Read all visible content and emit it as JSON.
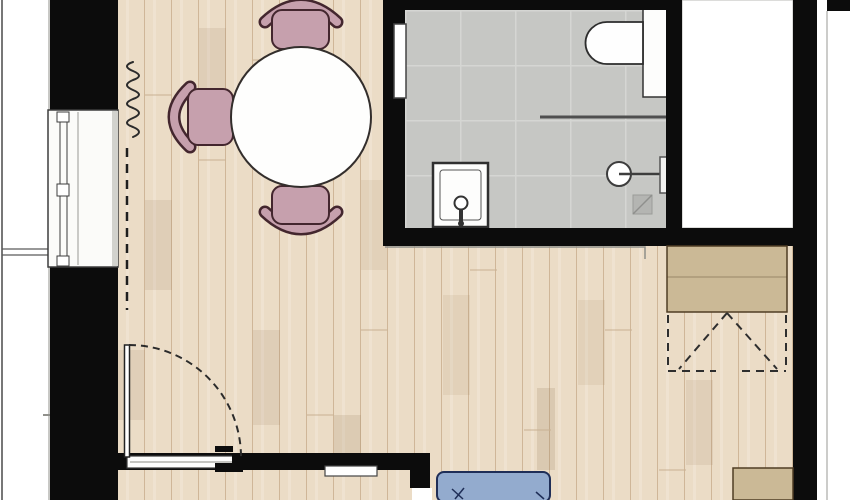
{
  "canvas": {
    "width": 850,
    "height": 500
  },
  "colors": {
    "wall": "#0c0c0c",
    "wood_floor": "#ebdcc6",
    "wood_plank_line": "#cfb698",
    "tile_floor": "#c6c7c4",
    "tile_grid_line": "#d5d6d3",
    "chair_pink": "#c6a0ad",
    "chair_outline": "#43262e",
    "table_white": "#fefefd",
    "wardrobe_tan": "#cbb996",
    "wardrobe_outline": "#4f3d24",
    "sofa_blue": "#93abce",
    "sofa_outline": "#1f2e57",
    "fixture_white": "#fdfdfc",
    "fixture_outline": "#2d2d2d",
    "exterior_white": "#ffffff"
  },
  "elements": [
    {
      "name": "exterior-ground",
      "type": "rect",
      "x": 0,
      "y": 0,
      "w": 850,
      "h": 500,
      "fill": "#ffffff"
    },
    {
      "name": "wood-floor",
      "type": "rect",
      "x": 118,
      "y": 0,
      "w": 675,
      "h": 500,
      "fill": "url(#wood)"
    },
    {
      "name": "plank-shade",
      "type": "rect",
      "x": 145,
      "y": 200,
      "w": 27,
      "h": 90,
      "fill": "rgba(146,117,82,0.13)"
    },
    {
      "name": "plank-shade",
      "type": "rect",
      "x": 199,
      "y": 28,
      "w": 27,
      "h": 75,
      "fill": "rgba(146,117,82,0.13)"
    },
    {
      "name": "plank-shade",
      "type": "rect",
      "x": 253,
      "y": 330,
      "w": 27,
      "h": 95,
      "fill": "rgba(146,117,82,0.13)"
    },
    {
      "name": "plank-shade",
      "type": "rect",
      "x": 334,
      "y": 415,
      "w": 27,
      "h": 55,
      "fill": "rgba(146,117,82,0.16)"
    },
    {
      "name": "plank-shade",
      "type": "rect",
      "x": 361,
      "y": 180,
      "w": 26,
      "h": 90,
      "fill": "rgba(146,117,82,0.10)"
    },
    {
      "name": "plank-shade",
      "type": "rect",
      "x": 443,
      "y": 295,
      "w": 27,
      "h": 100,
      "fill": "rgba(146,117,82,0.10)"
    },
    {
      "name": "plank-shade",
      "type": "rect",
      "x": 537,
      "y": 388,
      "w": 18,
      "h": 82,
      "fill": "rgba(146,117,82,0.18)"
    },
    {
      "name": "plank-shade",
      "type": "rect",
      "x": 578,
      "y": 300,
      "w": 27,
      "h": 85,
      "fill": "rgba(146,117,82,0.10)"
    },
    {
      "name": "plank-shade",
      "type": "rect",
      "x": 686,
      "y": 380,
      "w": 27,
      "h": 85,
      "fill": "rgba(146,117,82,0.12)"
    },
    {
      "name": "plank-shade",
      "type": "rect",
      "x": 118,
      "y": 350,
      "w": 27,
      "h": 70,
      "fill": "rgba(146,117,82,0.12)"
    },
    {
      "name": "plank-joint",
      "type": "path",
      "d": "M145 95 H172",
      "stroke": "#c8b193",
      "sw": 1
    },
    {
      "name": "plank-joint",
      "type": "path",
      "d": "M199 160 H226",
      "stroke": "#c8b193",
      "sw": 1
    },
    {
      "name": "plank-joint",
      "type": "path",
      "d": "M253 60 H280",
      "stroke": "#c8b193",
      "sw": 1
    },
    {
      "name": "plank-joint",
      "type": "path",
      "d": "M307 415 H334",
      "stroke": "#c8b193",
      "sw": 1
    },
    {
      "name": "plank-joint",
      "type": "path",
      "d": "M361 330 H388",
      "stroke": "#c8b193",
      "sw": 1
    },
    {
      "name": "plank-joint",
      "type": "path",
      "d": "M470 270 H497",
      "stroke": "#c8b193",
      "sw": 1
    },
    {
      "name": "plank-joint",
      "type": "path",
      "d": "M524 430 H551",
      "stroke": "#c8b193",
      "sw": 1
    },
    {
      "name": "plank-joint",
      "type": "path",
      "d": "M605 330 H632",
      "stroke": "#c8b193",
      "sw": 1
    },
    {
      "name": "plank-joint",
      "type": "path",
      "d": "M659 470 H686",
      "stroke": "#c8b193",
      "sw": 1
    },
    {
      "name": "plank-joint",
      "type": "path",
      "d": "M713 300 H740",
      "stroke": "#c8b193",
      "sw": 1
    },
    {
      "name": "balcony-edge-line",
      "type": "path",
      "d": "M2 0 V500",
      "stroke": "#4a4a4a",
      "sw": 1.5
    },
    {
      "name": "facade-line-left",
      "type": "path",
      "d": "M49 0 V500",
      "stroke": "#90908b",
      "sw": 1
    },
    {
      "name": "balcony-divider-line",
      "type": "path",
      "d": "M2 249 H50",
      "stroke": "#5a5a5a",
      "sw": 1.2
    },
    {
      "name": "balcony-divider-line",
      "type": "path",
      "d": "M2 255 H50",
      "stroke": "#5a5a5a",
      "sw": 1.2
    },
    {
      "name": "facade-mark",
      "type": "path",
      "d": "M43 415 H51",
      "stroke": "#90908b",
      "sw": 2
    },
    {
      "name": "radiator-symbol",
      "type": "path",
      "d": "M133 62 Q121 66 133 71 Q145 76 133 80 Q121 85 133 90 Q145 95 133 99 Q121 104 133 108 Q145 113 133 118 Q121 123 133 127 Q145 132 133 137",
      "stroke": "#2b2b2b",
      "sw": 2,
      "cap": "round"
    },
    {
      "name": "projection-dashed-line",
      "type": "path",
      "d": "M127 148 V310",
      "stroke": "#1e1e1e",
      "sw": 2.5,
      "dash": "9 7"
    },
    {
      "name": "chair-top-back-outline",
      "type": "path",
      "d": "M265 22 Q301 -12 337 22",
      "stroke": "#43262e",
      "sw": 13,
      "cap": "round"
    },
    {
      "name": "chair-top-back",
      "type": "path",
      "d": "M265 22 Q301 -12 337 22",
      "stroke": "#c6a0ad",
      "sw": 8,
      "cap": "round"
    },
    {
      "name": "chair-top-seat",
      "type": "rect",
      "x": 272,
      "y": 10,
      "w": 57,
      "h": 39,
      "rx": 10,
      "fill": "#c6a0ad",
      "stroke": "#43262e",
      "sw": 2
    },
    {
      "name": "chair-left-back-outline",
      "type": "path",
      "d": "M190 87 Q158 117 190 147",
      "stroke": "#43262e",
      "sw": 13,
      "cap": "round"
    },
    {
      "name": "chair-left-back",
      "type": "path",
      "d": "M190 87 Q158 117 190 147",
      "stroke": "#c6a0ad",
      "sw": 8,
      "cap": "round"
    },
    {
      "name": "chair-left-seat",
      "type": "rect",
      "x": 188,
      "y": 89,
      "w": 45,
      "h": 56,
      "rx": 10,
      "fill": "#c6a0ad",
      "stroke": "#43262e",
      "sw": 2
    },
    {
      "name": "chair-bottom-back-outline",
      "type": "path",
      "d": "M265 212 Q301 246 337 212",
      "stroke": "#43262e",
      "sw": 13,
      "cap": "round"
    },
    {
      "name": "chair-bottom-back",
      "type": "path",
      "d": "M265 212 Q301 246 337 212",
      "stroke": "#c6a0ad",
      "sw": 8,
      "cap": "round"
    },
    {
      "name": "chair-bottom-seat",
      "type": "rect",
      "x": 272,
      "y": 186,
      "w": 57,
      "h": 38,
      "rx": 10,
      "fill": "#c6a0ad",
      "stroke": "#43262e",
      "sw": 2
    },
    {
      "name": "dining-table",
      "type": "circle",
      "cx": 301,
      "cy": 117,
      "r": 70,
      "fill": "#fefefd",
      "stroke": "#332e2c",
      "sw": 2
    },
    {
      "name": "bathroom-floor",
      "type": "rect",
      "x": 405,
      "y": 10,
      "w": 261,
      "h": 218,
      "fill": "url(#tile)"
    },
    {
      "name": "shower-partition-line",
      "type": "path",
      "d": "M540 117 H666",
      "stroke": "#4f4f4f",
      "sw": 3
    },
    {
      "name": "toilet-cistern-panel",
      "type": "rect",
      "x": 643,
      "y": 8,
      "w": 24,
      "h": 89,
      "fill": "#fdfdfc",
      "stroke": "#333333",
      "sw": 1.5
    },
    {
      "name": "toilet-bowl",
      "type": "path",
      "d": "M643 22 H607 A21.5 21 0 0 0 607 64 H643 Z",
      "fill": "#fefefe",
      "stroke": "#2d2d2d",
      "sw": 1.8
    },
    {
      "name": "shower-tray",
      "type": "rect",
      "x": 433,
      "y": 163,
      "w": 55,
      "h": 64,
      "fill": "#fdfdfc",
      "stroke": "#2f2f2f",
      "sw": 2.5
    },
    {
      "name": "shower-tray-inner",
      "type": "rect",
      "x": 440,
      "y": 170,
      "w": 41,
      "h": 50,
      "rx": 3,
      "fill": "none",
      "stroke": "#555555",
      "sw": 1
    },
    {
      "name": "shower-valve",
      "type": "circle",
      "cx": 461,
      "cy": 203,
      "r": 6.5,
      "fill": "#ffffff",
      "stroke": "#333333",
      "sw": 2
    },
    {
      "name": "shower-valve-stem",
      "type": "path",
      "d": "M461 209 V222",
      "stroke": "#333333",
      "sw": 4
    },
    {
      "name": "shower-valve-base",
      "type": "circle",
      "cx": 461,
      "cy": 223.5,
      "r": 3,
      "fill": "#333333"
    },
    {
      "name": "washbasin",
      "type": "circle",
      "cx": 619,
      "cy": 174,
      "r": 12,
      "fill": "#ffffff",
      "stroke": "#3d3d3d",
      "sw": 2
    },
    {
      "name": "washbasin-faucet-line",
      "type": "path",
      "d": "M619 174 H663",
      "stroke": "#3d3d3d",
      "sw": 2.5
    },
    {
      "name": "washbasin-bracket",
      "type": "rect",
      "x": 660,
      "y": 157,
      "w": 10,
      "h": 36,
      "fill": "#f2f2f0",
      "stroke": "#555555",
      "sw": 1.5
    },
    {
      "name": "floor-drain",
      "type": "rect",
      "x": 633,
      "y": 195,
      "w": 19,
      "h": 19,
      "fill": "#b4b5b2",
      "stroke": "#9b9c99",
      "sw": 1
    },
    {
      "name": "floor-drain-diagonal",
      "type": "path",
      "d": "M633 214 L652 195",
      "stroke": "#8f908d",
      "sw": 1.5
    },
    {
      "name": "shaft-room",
      "type": "rect",
      "x": 682,
      "y": 0,
      "w": 111,
      "h": 228,
      "fill": "#ffffff",
      "stroke": "#b8b8b4",
      "sw": 1
    },
    {
      "name": "wall-bathroom-top",
      "type": "rect",
      "x": 383,
      "y": 0,
      "w": 299,
      "h": 10,
      "fill": "#0c0c0c"
    },
    {
      "name": "wall-bathroom-left",
      "type": "rect",
      "x": 383,
      "y": 10,
      "w": 22,
      "h": 218,
      "fill": "#0c0c0c"
    },
    {
      "name": "wall-bathroom-right",
      "type": "rect",
      "x": 666,
      "y": 10,
      "w": 16,
      "h": 218,
      "fill": "#0c0c0c"
    },
    {
      "name": "wall-bathroom-bottom",
      "type": "rect",
      "x": 383,
      "y": 228,
      "w": 410,
      "h": 18,
      "fill": "#0c0c0c"
    },
    {
      "name": "wall-right",
      "type": "rect",
      "x": 793,
      "y": 0,
      "w": 24,
      "h": 500,
      "fill": "#0c0c0c"
    },
    {
      "name": "wall-left-top",
      "type": "rect",
      "x": 50,
      "y": 0,
      "w": 68,
      "h": 110,
      "fill": "#0c0c0c"
    },
    {
      "name": "wall-left-bottom",
      "type": "rect",
      "x": 50,
      "y": 267,
      "w": 68,
      "h": 233,
      "fill": "#0c0c0c"
    },
    {
      "name": "wall-bottom",
      "type": "rect",
      "x": 118,
      "y": 453,
      "w": 312,
      "h": 17,
      "fill": "#0c0c0c"
    },
    {
      "name": "wall-bottom-stub",
      "type": "rect",
      "x": 410,
      "y": 453,
      "w": 20,
      "h": 35,
      "fill": "#0c0c0c"
    },
    {
      "name": "bathroom-door-panel",
      "type": "rect",
      "x": 394,
      "y": 24,
      "w": 12,
      "h": 74,
      "fill": "#ffffff",
      "stroke": "#444444",
      "sw": 1.5
    },
    {
      "name": "floor-step-line",
      "type": "path",
      "d": "M385 247 H645 V259",
      "stroke": "#8e8e89",
      "sw": 1.5
    },
    {
      "name": "window-frame",
      "type": "rect",
      "x": 48,
      "y": 110,
      "w": 70,
      "h": 157,
      "fill": "#fbfbf9",
      "stroke": "#3d3d3d",
      "sw": 1.5
    },
    {
      "name": "window-glazing-line",
      "type": "path",
      "d": "M60 112 V265",
      "stroke": "#3d3d3d",
      "sw": 1
    },
    {
      "name": "window-glazing-line",
      "type": "path",
      "d": "M67 112 V265",
      "stroke": "#3d3d3d",
      "sw": 1
    },
    {
      "name": "window-glazing-line",
      "type": "path",
      "d": "M78 112 V265",
      "stroke": "#9a9a95",
      "sw": 1
    },
    {
      "name": "window-mullion-block",
      "type": "rect",
      "x": 57,
      "y": 112,
      "w": 12,
      "h": 10,
      "fill": "#ffffff",
      "stroke": "#3d3d3d",
      "sw": 1
    },
    {
      "name": "window-mullion-block",
      "type": "rect",
      "x": 57,
      "y": 184,
      "w": 12,
      "h": 12,
      "fill": "#ffffff",
      "stroke": "#3d3d3d",
      "sw": 1
    },
    {
      "name": "window-mullion-block",
      "type": "rect",
      "x": 57,
      "y": 256,
      "w": 12,
      "h": 10,
      "fill": "#ffffff",
      "stroke": "#3d3d3d",
      "sw": 1
    },
    {
      "name": "window-sill-shade",
      "type": "rect",
      "x": 112,
      "y": 111,
      "w": 6,
      "h": 155,
      "fill": "#d2d2cd"
    },
    {
      "name": "wardrobe",
      "type": "rect",
      "x": 667,
      "y": 246,
      "w": 120,
      "h": 66,
      "fill": "#cbb996",
      "stroke": "#4f3d24",
      "sw": 1.5
    },
    {
      "name": "wardrobe-divider-line",
      "type": "path",
      "d": "M667 277 H787",
      "stroke": "rgba(79,61,36,0.4)",
      "sw": 1
    },
    {
      "name": "wardrobe-clearance-dashed",
      "type": "path",
      "d": "M668 315 V371",
      "stroke": "#2e2e2e",
      "sw": 2,
      "dash": "8 6"
    },
    {
      "name": "wardrobe-clearance-dashed",
      "type": "path",
      "d": "M786 315 V371",
      "stroke": "#2e2e2e",
      "sw": 2,
      "dash": "8 6"
    },
    {
      "name": "wardrobe-clearance-dashed",
      "type": "path",
      "d": "M668 371 H716",
      "stroke": "#2e2e2e",
      "sw": 2,
      "dash": "8 6"
    },
    {
      "name": "wardrobe-clearance-dashed",
      "type": "path",
      "d": "M742 371 H786",
      "stroke": "#2e2e2e",
      "sw": 2,
      "dash": "8 6"
    },
    {
      "name": "wardrobe-door-swing-dashed",
      "type": "path",
      "d": "M727 313 L679 369",
      "stroke": "#2e2e2e",
      "sw": 2,
      "dash": "8 6"
    },
    {
      "name": "wardrobe-door-swing-dashed",
      "type": "path",
      "d": "M727 313 L777 369",
      "stroke": "#2e2e2e",
      "sw": 2,
      "dash": "8 6"
    },
    {
      "name": "cabinet-bottom-right",
      "type": "rect",
      "x": 733,
      "y": 468,
      "w": 60,
      "h": 32,
      "fill": "#cbb996",
      "stroke": "#4f3d24",
      "sw": 1.5
    },
    {
      "name": "entry-door-sill",
      "type": "rect",
      "x": 127,
      "y": 456,
      "w": 111,
      "h": 12,
      "fill": "#fdfdfc",
      "stroke": "#3a3a3a",
      "sw": 1.2
    },
    {
      "name": "entry-door-sill-line",
      "type": "path",
      "d": "M130 462 H235",
      "stroke": "#8a8a85",
      "sw": 1
    },
    {
      "name": "entry-door-strike-upper",
      "type": "rect",
      "x": 215,
      "y": 446,
      "w": 18,
      "h": 6,
      "fill": "#0c0c0c"
    },
    {
      "name": "entry-door-strike-block",
      "type": "rect",
      "x": 232,
      "y": 453,
      "w": 11,
      "h": 19,
      "fill": "#0c0c0c"
    },
    {
      "name": "entry-door-strike-lower",
      "type": "rect",
      "x": 215,
      "y": 463,
      "w": 17,
      "h": 9,
      "fill": "#0c0c0c"
    },
    {
      "name": "entry-door-leaf",
      "type": "rect",
      "x": 124.5,
      "y": 345,
      "w": 5,
      "h": 112,
      "fill": "#ffffff",
      "stroke": "#222222",
      "sw": 1.5
    },
    {
      "name": "entry-door-swing-arc",
      "type": "path",
      "d": "M129 345 A112 112 0 0 1 241 457",
      "stroke": "#2b2b2b",
      "sw": 2,
      "dash": "7 5"
    },
    {
      "name": "lower-wall-opening",
      "type": "rect",
      "x": 325,
      "y": 466,
      "w": 52,
      "h": 10,
      "fill": "#ffffff",
      "stroke": "#444444",
      "sw": 1.2
    },
    {
      "name": "wall-stub-notch",
      "type": "rect",
      "x": 412,
      "y": 488,
      "w": 20,
      "h": 12,
      "fill": "#ffffff"
    },
    {
      "name": "sofa",
      "type": "rect",
      "x": 437,
      "y": 472,
      "w": 113,
      "h": 30,
      "rx": 7,
      "fill": "#93abce",
      "stroke": "#1f2e57",
      "sw": 2
    },
    {
      "name": "sofa-pillow-mark",
      "type": "path",
      "d": "M452 489 L463 499 M464 488 L455 499",
      "stroke": "#1f2e57",
      "sw": 1.5
    },
    {
      "name": "sofa-corner-mark",
      "type": "path",
      "d": "M536 492 L544 499",
      "stroke": "#1f2e57",
      "sw": 1.5
    },
    {
      "name": "wall-corner-top-right",
      "type": "rect",
      "x": 827,
      "y": 0,
      "w": 23,
      "h": 11,
      "fill": "#0c0c0c"
    },
    {
      "name": "facade-line-right",
      "type": "path",
      "d": "M827 11 V500",
      "stroke": "#9a9a95",
      "sw": 1
    }
  ]
}
